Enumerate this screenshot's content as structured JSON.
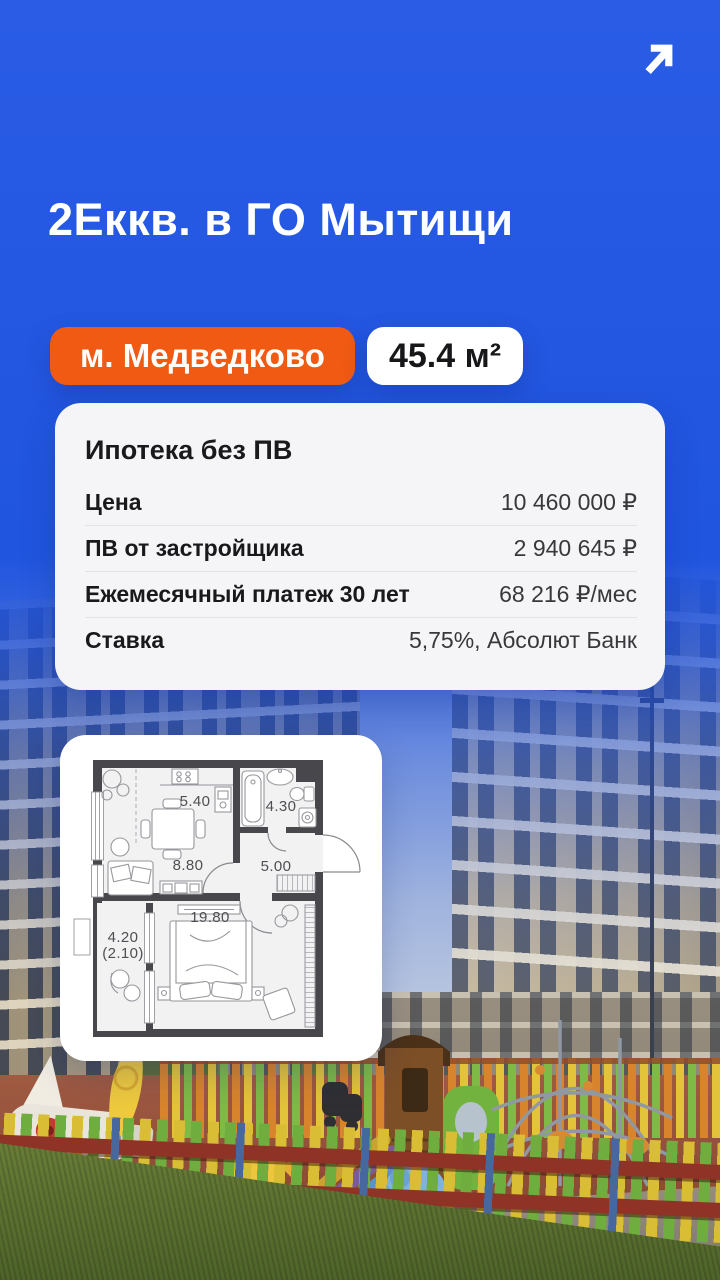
{
  "header": {
    "title": "2Еккв. в ГО Мытищи",
    "arrow_icon": "arrow-up-right"
  },
  "badges": {
    "metro": "м. Медведково",
    "area": "45.4 м²"
  },
  "mortgage": {
    "title": "Ипотека без ПВ",
    "rows": [
      {
        "label": "Цена",
        "value": "10 460 000 ₽"
      },
      {
        "label": "ПВ от застройщика",
        "value": "2 940 645 ₽"
      },
      {
        "label": "Ежемесячный платеж 30 лет",
        "value": "68 216 ₽/мес"
      },
      {
        "label": "Ставка",
        "value": "5,75%, Абсолют Банк"
      }
    ]
  },
  "floorplan": {
    "labels": {
      "kitchen": "5.40",
      "bathroom": "4.30",
      "living": "8.80",
      "hall": "5.00",
      "bedroom": "19.80",
      "balcony": "4.20",
      "balcony_reduced": "(2.10)"
    }
  },
  "colors": {
    "background_blue": "#2055df",
    "badge_orange": "#f05a12",
    "card_background": "#f5f5f7",
    "text_dark": "#19191b"
  }
}
